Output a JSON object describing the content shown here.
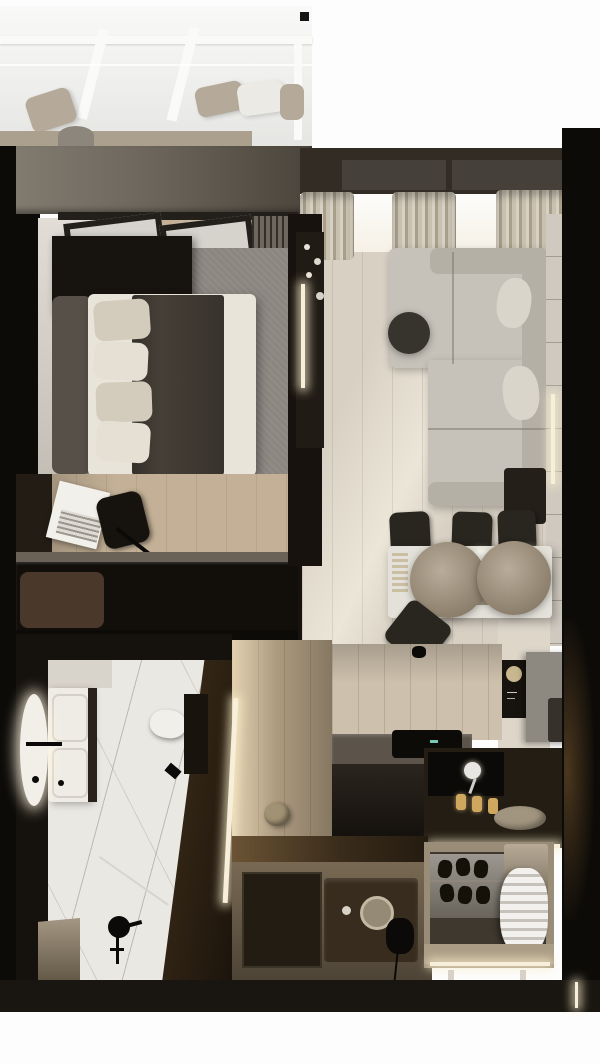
{
  "scene": {
    "title": "apartment-floor-plan-top-view",
    "style": "photorealistic 3D render, top-down studio apartment",
    "palette": {
      "page_bg": "#fdfdfd",
      "outer_wall": "#0d0b08",
      "bedroom_top_wall": "#6e675d",
      "living_top_wall": "#322c25",
      "window_recess": "#46403a",
      "window_light": "#f7f3e9",
      "curtain": "#c2b8a5",
      "balcony_glass": "#ececea",
      "balcony_frame": "#fafaf9",
      "balcony_ledge": "#aba08e",
      "cushion_beige": "#b5aa99",
      "cushion_white": "#eceae4",
      "bedroom_floor": "#c3b096",
      "bedroom_left_floor": "#d2ccc1",
      "rug": "#8b8680",
      "door_glass": "#d6d3cd",
      "door_frame": "#23201b",
      "radiator": "#6e675d",
      "nightstand": "#17130f",
      "headboard": "#575048",
      "duvet": "#e9e4da",
      "throw": "#453f37",
      "pillow_beige": "#d3ccbd",
      "pillow_white": "#e6e0d4",
      "desk": "#221c15",
      "laptop": "#f2f0ea",
      "chair_dark": "#16120d",
      "sideboard": "#120e0a",
      "sideboard_wall": "#6a6257",
      "bench_cushion": "#4a392b",
      "partition": "#17120d",
      "tv_panel": "#201b15",
      "led_warm": "#f8efda",
      "living_floor": "#d8d0c3",
      "sofa": "#c6c2b9",
      "sofa_back": "#b4b0a6",
      "sofa_pillow": "#d9d5cb",
      "coffee_table": "#37332d",
      "wall_panel": "#cfc9bf",
      "side_table": "#241f19",
      "dining_table": "#e4e1da",
      "pendant_shade": "#a89b88",
      "dining_chair": "#29251f",
      "plate": "#f4f2ec",
      "kitchen_wall": "#cdc0ac",
      "kitchen_column": "#ddd6c9",
      "art_panel": "#17130e",
      "art_gold": "#c8b78f",
      "fridge_gray": "#8d8981",
      "handle_dark": "#36322b",
      "counter_top": "#5c544a",
      "counter_front": "#1d1710",
      "counter_right": "#241d14",
      "hob": "#0d0b08",
      "hob_indicator": "#79c9b8",
      "faucet_white": "#e8e6e2",
      "bottle_amber": "#cfa75e",
      "tray": "#a1957f",
      "bath_wall": "#15110c",
      "marble": "#eae8e3",
      "vanity": "#efece6",
      "mirror_glow": "#f2efe9",
      "toilet": "#f1efe9",
      "cistern_wall": "#18130d",
      "fixture_black": "#0b0a08",
      "bench_tan": "#8d7c64",
      "bottle_white": "#e9e7e2",
      "bottle_blue": "#4a62a8",
      "corridor_floor": "#c0ab8d",
      "pouf": "#a29274",
      "entry_floor": "#8d7b62",
      "doormat": "#231c13",
      "console_wood": "#382c1e",
      "mirror_ring": "#c4b8a2",
      "wardrobe_frame": "#9a8d78",
      "wardrobe_interior": "#3e382f",
      "shoe_shelf": "#7b756b",
      "shoe_dark": "#141109",
      "garment_white": "#e6e3dc",
      "storage_box": "#a5967e",
      "bottom_wall": "#191510"
    },
    "rooms": [
      {
        "name": "balcony",
        "objects": [
          "glass-roof",
          "roof-mullions",
          "floor-cushions",
          "bench-ledge"
        ]
      },
      {
        "name": "bedroom",
        "objects": [
          "double-bed",
          "headboard",
          "pillows",
          "throw-blanket",
          "shag-rug",
          "nightstand",
          "balcony-doors",
          "radiator",
          "desk",
          "office-chair",
          "laptop",
          "sideboard",
          "bench-cushion"
        ]
      },
      {
        "name": "living-room",
        "objects": [
          "corner-sofa",
          "sofa-pillows",
          "coffee-table",
          "tv-partition",
          "led-strip",
          "curtains",
          "wall-light",
          "side-table",
          "wall-panels"
        ]
      },
      {
        "name": "dining-area",
        "objects": [
          "dining-table",
          "pendant-lamps",
          "dining-chairs",
          "plates",
          "serving-tray"
        ]
      },
      {
        "name": "kitchen",
        "objects": [
          "l-shaped-counter",
          "induction-hob",
          "sink",
          "faucet",
          "tall-cabinet",
          "fridge-cabinet",
          "art-panel",
          "bottles",
          "serving-tray",
          "pendant-light",
          "under-cabinet-led"
        ]
      },
      {
        "name": "bathroom",
        "objects": [
          "vanity-basin",
          "backlit-round-mirror",
          "wall-faucet",
          "wall-hung-toilet",
          "shower-set",
          "glass-screen",
          "marble-floor",
          "toiletries",
          "bench-ledge"
        ]
      },
      {
        "name": "hallway",
        "objects": [
          "led-wall-strip",
          "round-pouf",
          "recessed-doormat",
          "entry-console",
          "round-mirror"
        ]
      },
      {
        "name": "wardrobe",
        "objects": [
          "shoe-shelves",
          "hanging-garment",
          "storage-box",
          "led-underlight",
          "legs"
        ]
      }
    ]
  }
}
